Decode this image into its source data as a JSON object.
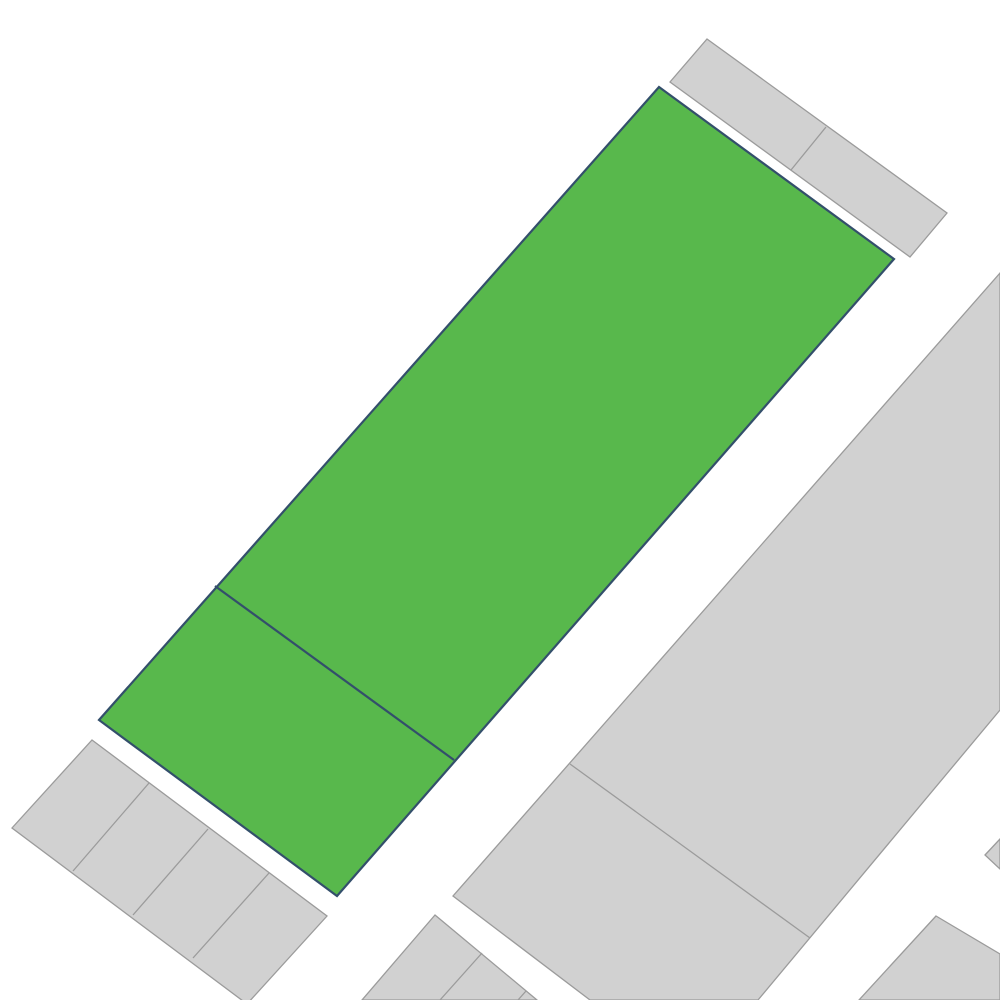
{
  "map": {
    "viewbox": "0 0 1000 1000",
    "background_color": "#ffffff",
    "styles": {
      "gray": {
        "fill": "#d1d1d1",
        "stroke": "#9b9b9b",
        "stroke_width": 1.3
      },
      "highlight": {
        "fill": "#58b84c",
        "stroke": "#334f6b",
        "stroke_width": 2.2
      }
    },
    "parcels": [
      {
        "name": "gray-parcel-top-right-strip",
        "style": "gray",
        "points": [
          [
            707,
            39
          ],
          [
            947,
            213
          ],
          [
            910,
            257
          ],
          [
            670,
            82
          ]
        ]
      },
      {
        "name": "gray-parcel-right-block",
        "style": "gray",
        "points": [
          [
            1000,
            273
          ],
          [
            453,
            896
          ],
          [
            590,
            1000
          ],
          [
            758,
            1000
          ],
          [
            1000,
            710
          ]
        ]
      },
      {
        "name": "gray-parcel-bottom-right-corner",
        "style": "gray",
        "points": [
          [
            936,
            916
          ],
          [
            1000,
            954
          ],
          [
            1000,
            1000
          ],
          [
            859,
            1000
          ]
        ]
      },
      {
        "name": "gray-parcel-right-edge-sliver",
        "style": "gray",
        "points": [
          [
            985,
            855
          ],
          [
            1000,
            839
          ],
          [
            1000,
            869
          ]
        ]
      },
      {
        "name": "gray-parcel-bottom-center",
        "style": "gray",
        "points": [
          [
            435,
            915
          ],
          [
            537,
            1000
          ],
          [
            362,
            1000
          ]
        ]
      },
      {
        "name": "gray-parcel-bottom-left-strip",
        "style": "gray",
        "points": [
          [
            92,
            740
          ],
          [
            327,
            916
          ],
          [
            247,
            1004
          ],
          [
            12,
            828
          ]
        ]
      },
      {
        "name": "highlighted-parcel",
        "style": "highlight",
        "points": [
          [
            659,
            87
          ],
          [
            894,
            259
          ],
          [
            337,
            896
          ],
          [
            99,
            720
          ]
        ]
      }
    ],
    "boundary_lines": [
      {
        "name": "lot-divider-top-right-strip",
        "style": "gray",
        "points": [
          [
            826,
            127
          ],
          [
            791,
            170
          ]
        ]
      },
      {
        "name": "lot-divider-right-block",
        "style": "gray",
        "points": [
          [
            570,
            764
          ],
          [
            810,
            938
          ]
        ]
      },
      {
        "name": "lot-divider-bottom-center-1",
        "style": "gray",
        "points": [
          [
            482,
            953
          ],
          [
            440,
            1000
          ]
        ]
      },
      {
        "name": "lot-divider-bottom-center-2",
        "style": "gray",
        "points": [
          [
            526,
            991
          ],
          [
            518,
            1000
          ]
        ]
      },
      {
        "name": "lot-divider-bottom-left-1",
        "style": "gray",
        "points": [
          [
            149,
            783
          ],
          [
            73,
            871
          ]
        ]
      },
      {
        "name": "lot-divider-bottom-left-2",
        "style": "gray",
        "points": [
          [
            208,
            829
          ],
          [
            133,
            915
          ]
        ]
      },
      {
        "name": "lot-divider-bottom-left-3",
        "style": "gray",
        "points": [
          [
            269,
            873
          ],
          [
            193,
            958
          ]
        ]
      },
      {
        "name": "highlighted-parcel-lot-divider",
        "style": "highlight",
        "points": [
          [
            215,
            586
          ],
          [
            454,
            760
          ]
        ]
      }
    ]
  }
}
